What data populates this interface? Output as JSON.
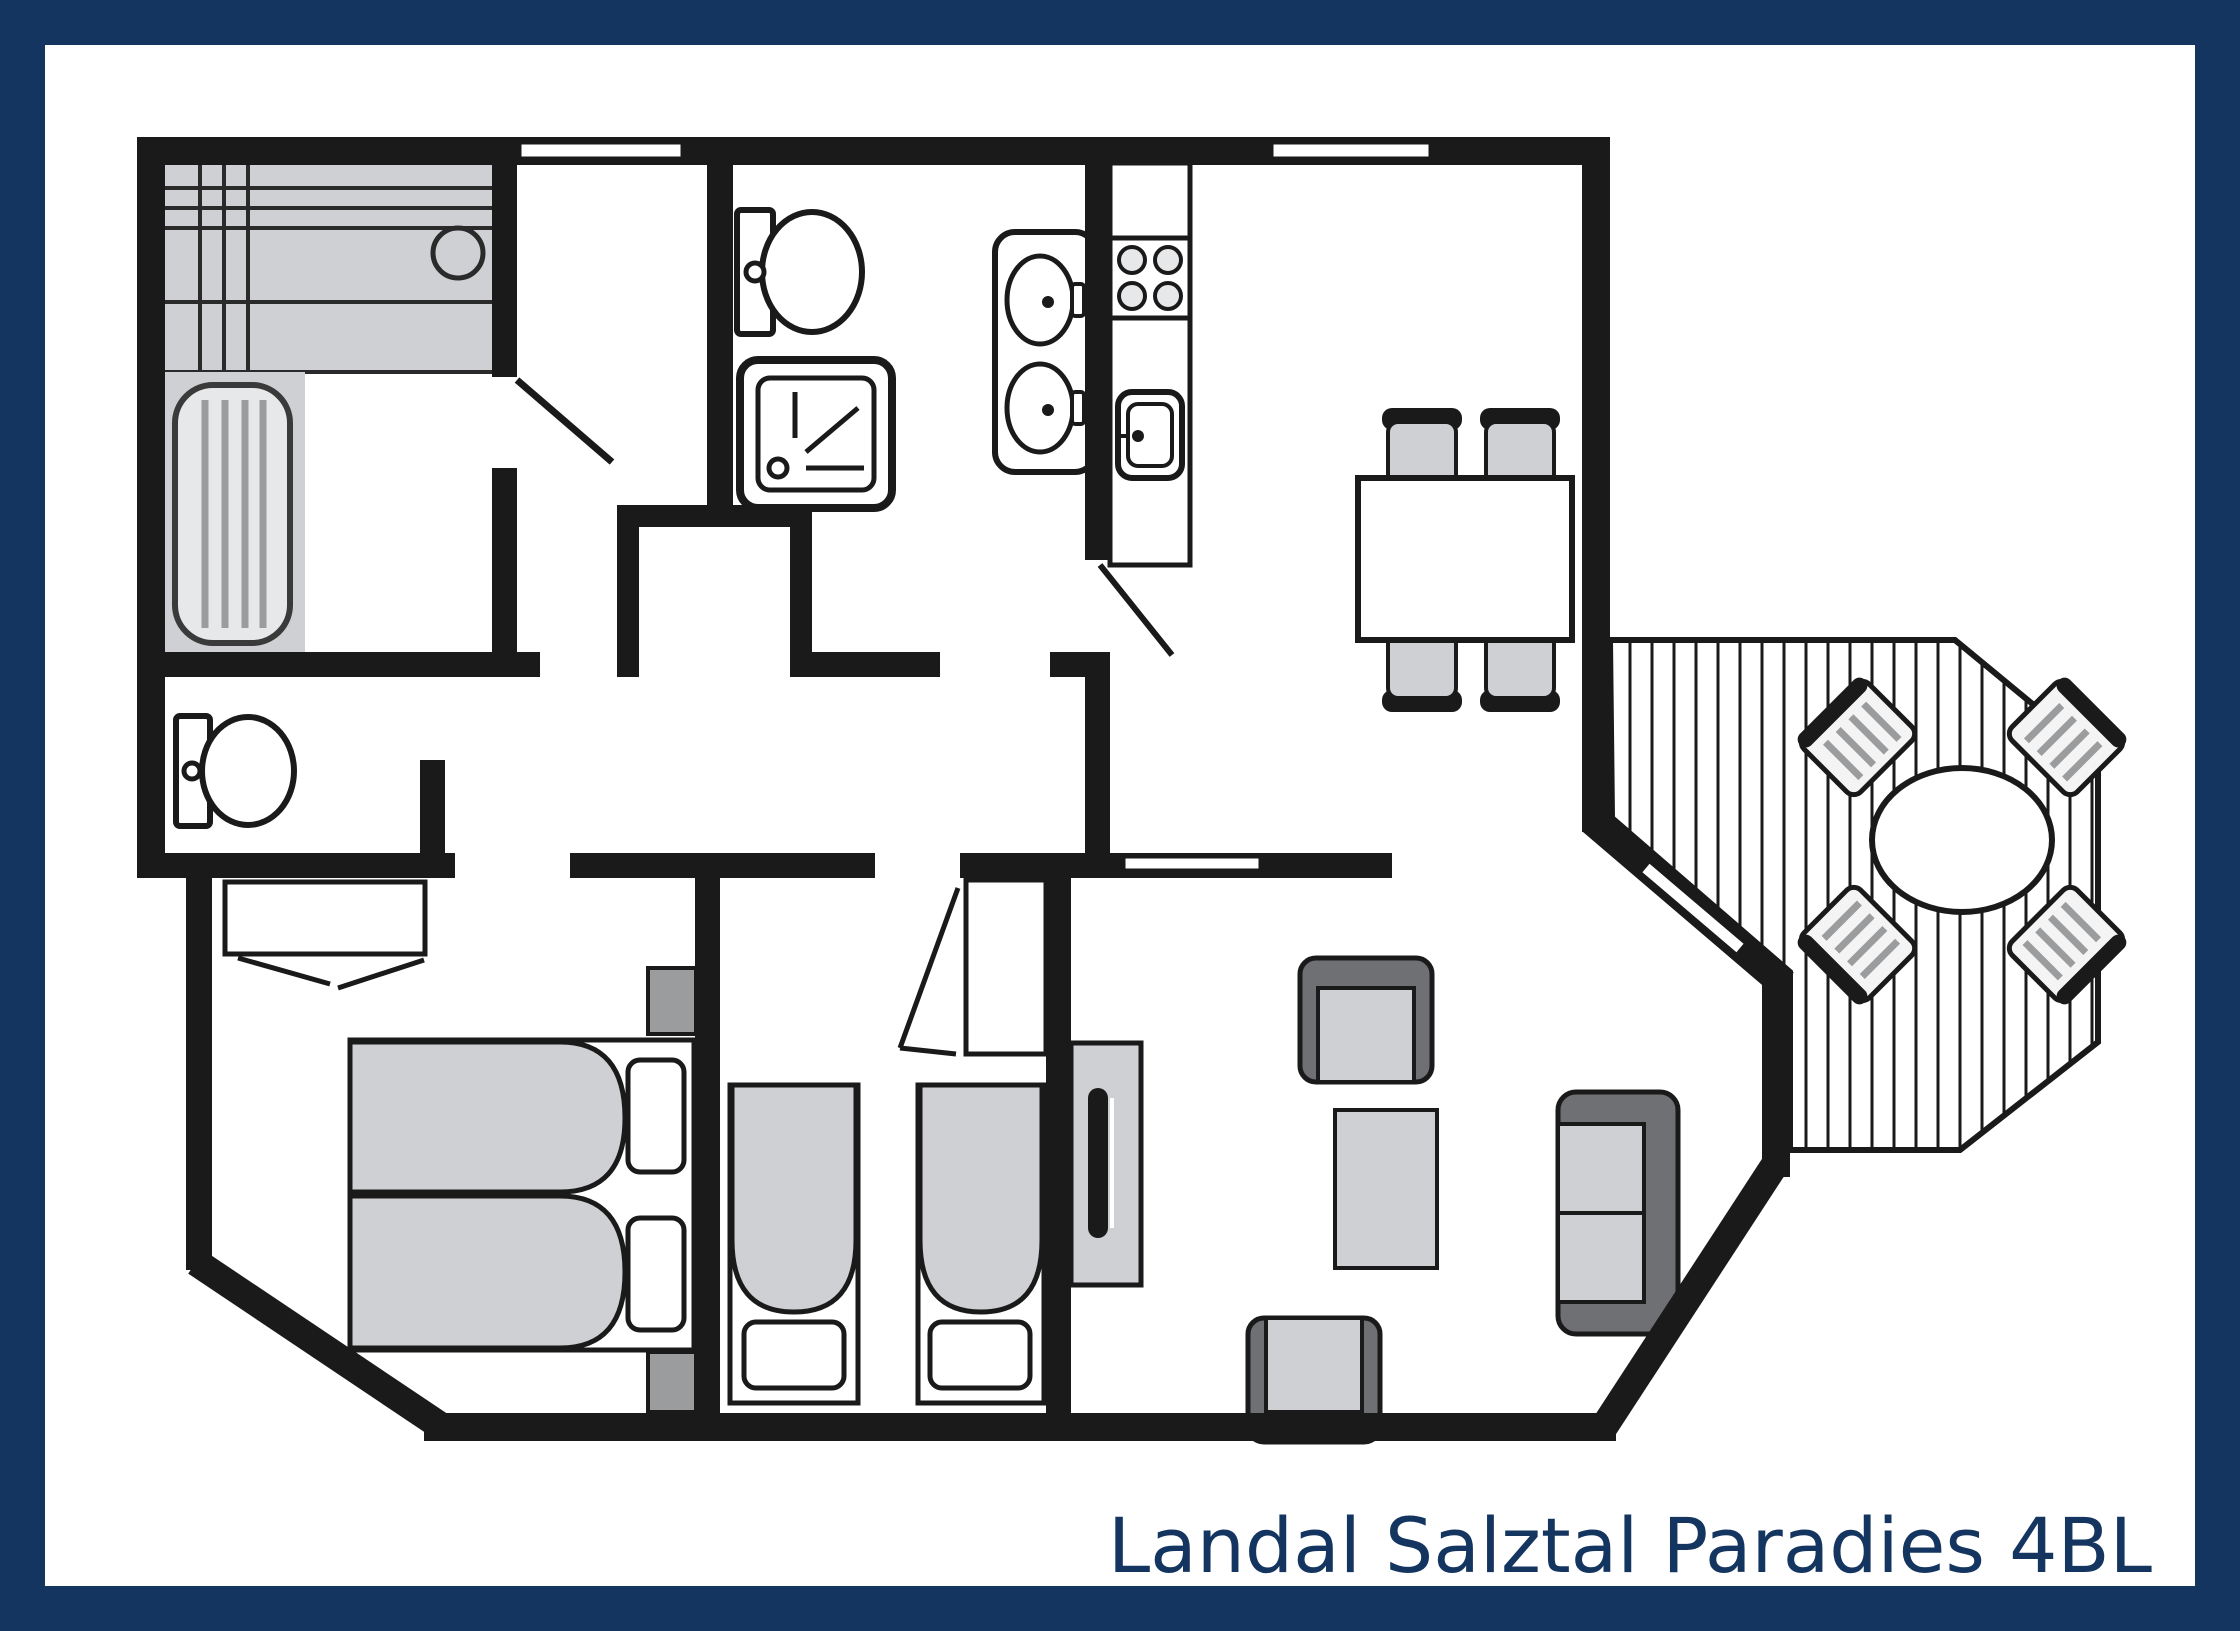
{
  "title": {
    "text": "Landal Salztal Paradies 4BL"
  },
  "colors": {
    "frame_navy": "#14355f",
    "wall_black": "#1a1a1a",
    "furniture_light_gray": "#cfd0d3",
    "furniture_mid_gray": "#9b9c9e",
    "furniture_dark_gray": "#6f7074",
    "paper_white": "#ffffff"
  },
  "floor_plan": {
    "type": "apartment-floor-plan",
    "rooms": [
      {
        "name": "sauna-room",
        "features": [
          "sauna-bench",
          "sauna-heater",
          "sauna-lounger",
          "door-swing"
        ]
      },
      {
        "name": "storage-room",
        "features": [
          "door-opening"
        ]
      },
      {
        "name": "bathroom",
        "features": [
          "toilet",
          "shower",
          "double-washbasin",
          "door-opening"
        ]
      },
      {
        "name": "separate-wc",
        "features": [
          "toilet",
          "door-opening"
        ]
      },
      {
        "name": "hallway",
        "features": [
          "closet-niche"
        ]
      },
      {
        "name": "kitchen",
        "features": [
          "counter",
          "stove-4-burners",
          "kitchen-sink",
          "door-swing"
        ]
      },
      {
        "name": "dining-area",
        "features": [
          "dining-table",
          "four-chairs",
          "window"
        ]
      },
      {
        "name": "living-room",
        "features": [
          "sofa",
          "two-armchairs",
          "coffee-table",
          "tv-cabinet",
          "terrace-door"
        ]
      },
      {
        "name": "bedroom-1",
        "features": [
          "double-bed",
          "two-pillows",
          "two-nightstands",
          "wardrobe",
          "window"
        ]
      },
      {
        "name": "bedroom-2",
        "features": [
          "single-bed",
          "single-bed",
          "wardrobe",
          "door-swing"
        ]
      },
      {
        "name": "terrace",
        "features": [
          "decking",
          "round-table",
          "four-deck-chairs"
        ]
      }
    ],
    "windows_in_top_wall": 2,
    "label_position": "bottom-right"
  }
}
